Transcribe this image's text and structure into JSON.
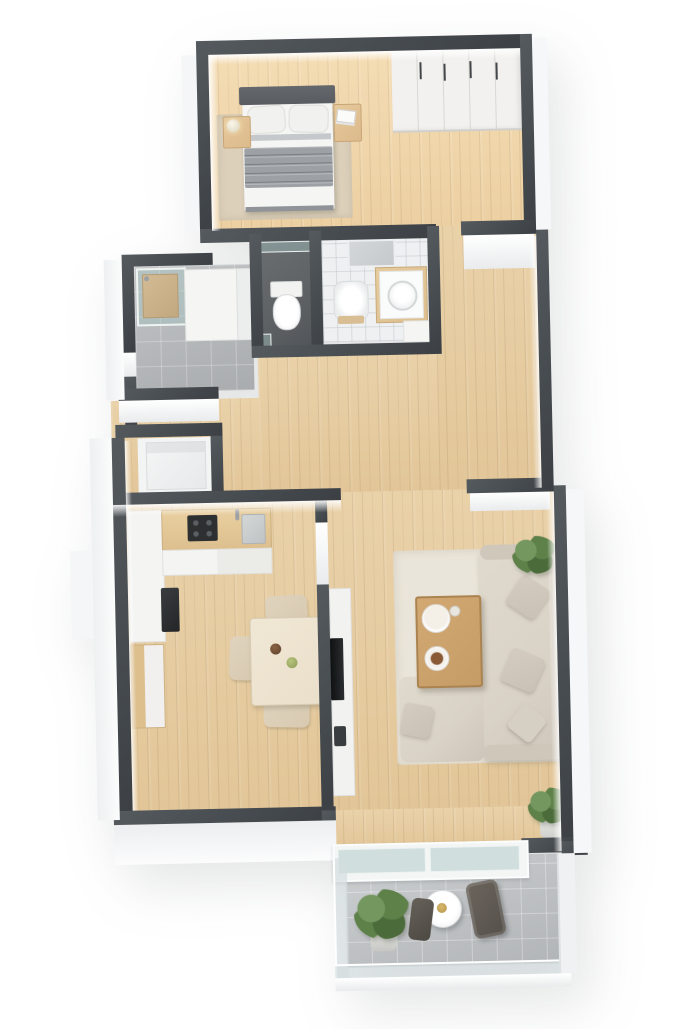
{
  "scene": {
    "description": "3D isometric rendered floor plan of a one-bedroom apartment with balcony, viewed from above on a white background",
    "background": "#ffffff"
  },
  "palette": {
    "wall": "#474c50",
    "floorWood": "#e7cc9f",
    "tileGray": "#b2b5b7",
    "tileWhite": "#eef0f1",
    "wcFloor": "#5e6164",
    "bedroomRug": "#dcd0bb",
    "livingRug": "#eae5da",
    "sofa": "#d9d2c6",
    "sofaShade": "#cfc7ba",
    "pillow": "#c9c1b4",
    "coffeeTable": "#c59c66",
    "diningTable": "#eadfca",
    "chairBeige": "#d8cab1",
    "counter": "#f4f4f3",
    "counterWood": "#ddbf8e",
    "cooktop": "#2d2f31",
    "bedHead": "#595d61",
    "duvet": "#9da1a5",
    "sheet": "#f5f5f4",
    "nightstand": "#dcba8b",
    "wardrobe": "#f2f1ef",
    "plantGreen": "#5e8049",
    "plantDark": "#4c6b3a",
    "plantLight": "#74975f",
    "mirror": "#c5c9cb",
    "balconyChair": "#55504a"
  },
  "rooms": {
    "bedroom": {
      "label": "Bedroom with double bed and wardrobe"
    },
    "shower_room": {
      "label": "Shower room with glass shower and cabinets"
    },
    "wc": {
      "label": "Separate WC"
    },
    "bathroom": {
      "label": "Bathroom with toilet, washbasin and mirror"
    },
    "hallway": {
      "label": "Hallway"
    },
    "storage": {
      "label": "Storage niche"
    },
    "kitchen": {
      "label": "Kitchen with cooktop and sink"
    },
    "dining": {
      "label": "Dining area"
    },
    "living": {
      "label": "Living room"
    },
    "balcony": {
      "label": "Balcony with bistro set and planter"
    }
  },
  "furniture": {
    "bed": {
      "label": "Double bed with grey striped duvet"
    },
    "nightstand_left": {
      "label": "Nightstand with lamp"
    },
    "nightstand_right": {
      "label": "Nightstand with books"
    },
    "wardrobe": {
      "label": "White wardrobe"
    },
    "shower": {
      "label": "Glass shower"
    },
    "wc_toilet": {
      "label": "Toilet"
    },
    "bath_toilet": {
      "label": "Toilet"
    },
    "washbasin": {
      "label": "Washbasin vanity"
    },
    "mirror": {
      "label": "Mirror"
    },
    "kitchen_counter": {
      "label": "Kitchen counter"
    },
    "cooktop": {
      "label": "Cooktop"
    },
    "sink": {
      "label": "Kitchen sink"
    },
    "oven": {
      "label": "Built-in appliance"
    },
    "sideboard": {
      "label": "Sideboard"
    },
    "dining_table": {
      "label": "Dining table with bowls"
    },
    "dining_chair": {
      "label": "Dining chair"
    },
    "tv": {
      "label": "TV on lowboard"
    },
    "sofa": {
      "label": "Corner sofa with cushions"
    },
    "coffee_table": {
      "label": "Coffee table with tableware"
    },
    "rug": {
      "label": "Rug"
    },
    "plant": {
      "label": "Potted plant"
    },
    "balcony_table": {
      "label": "Round bistro table"
    },
    "balcony_chair": {
      "label": "Balcony chair"
    },
    "balcony_plant": {
      "label": "Balcony planter"
    }
  }
}
